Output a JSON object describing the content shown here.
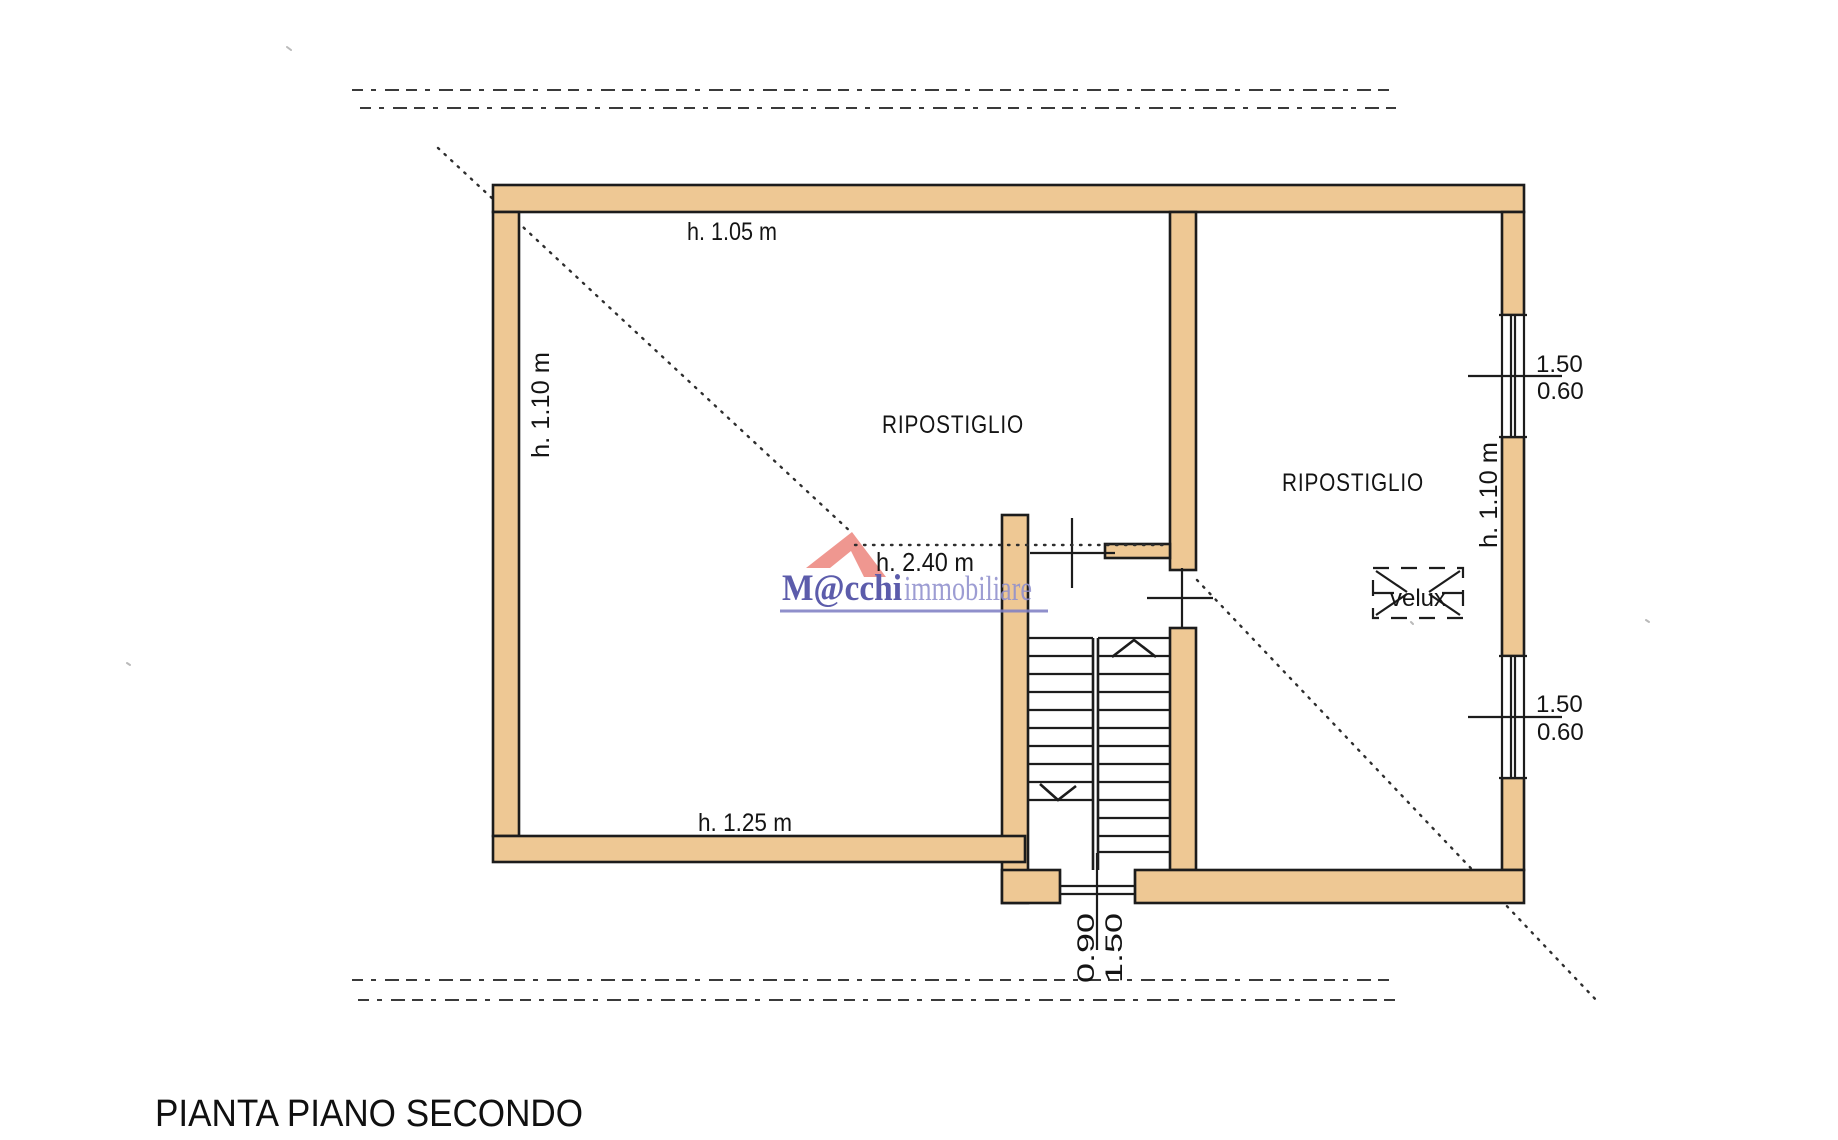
{
  "document": {
    "title": "PIANTA PIANO SECONDO"
  },
  "watermark": {
    "brand_primary": "M@cchi",
    "brand_secondary": "immobiliare"
  },
  "rooms": {
    "left": {
      "label": "RIPOSTIGLIO"
    },
    "right": {
      "label": "RIPOSTIGLIO"
    },
    "skylight": {
      "label": "velux"
    }
  },
  "heights": {
    "top_wall": "h. 1.05 m",
    "left_wall": "h. 1.10 m",
    "center": "h. 2.40 m",
    "bottom_wall": "h. 1.25 m",
    "right_wall": "h. 1.10 m"
  },
  "openings": {
    "window_upper": {
      "width": "1.50",
      "sill": "0.60"
    },
    "window_lower": {
      "width": "1.50",
      "sill": "0.60"
    },
    "door_bottom": {
      "width": "0.90",
      "height": "1.50"
    }
  },
  "colors": {
    "wall_fill": "#eec894",
    "ink": "#1c1c1c",
    "brand_blue": "#4646a0",
    "brand_blue_light": "#9090ce",
    "roof_red": "#e96b62"
  }
}
